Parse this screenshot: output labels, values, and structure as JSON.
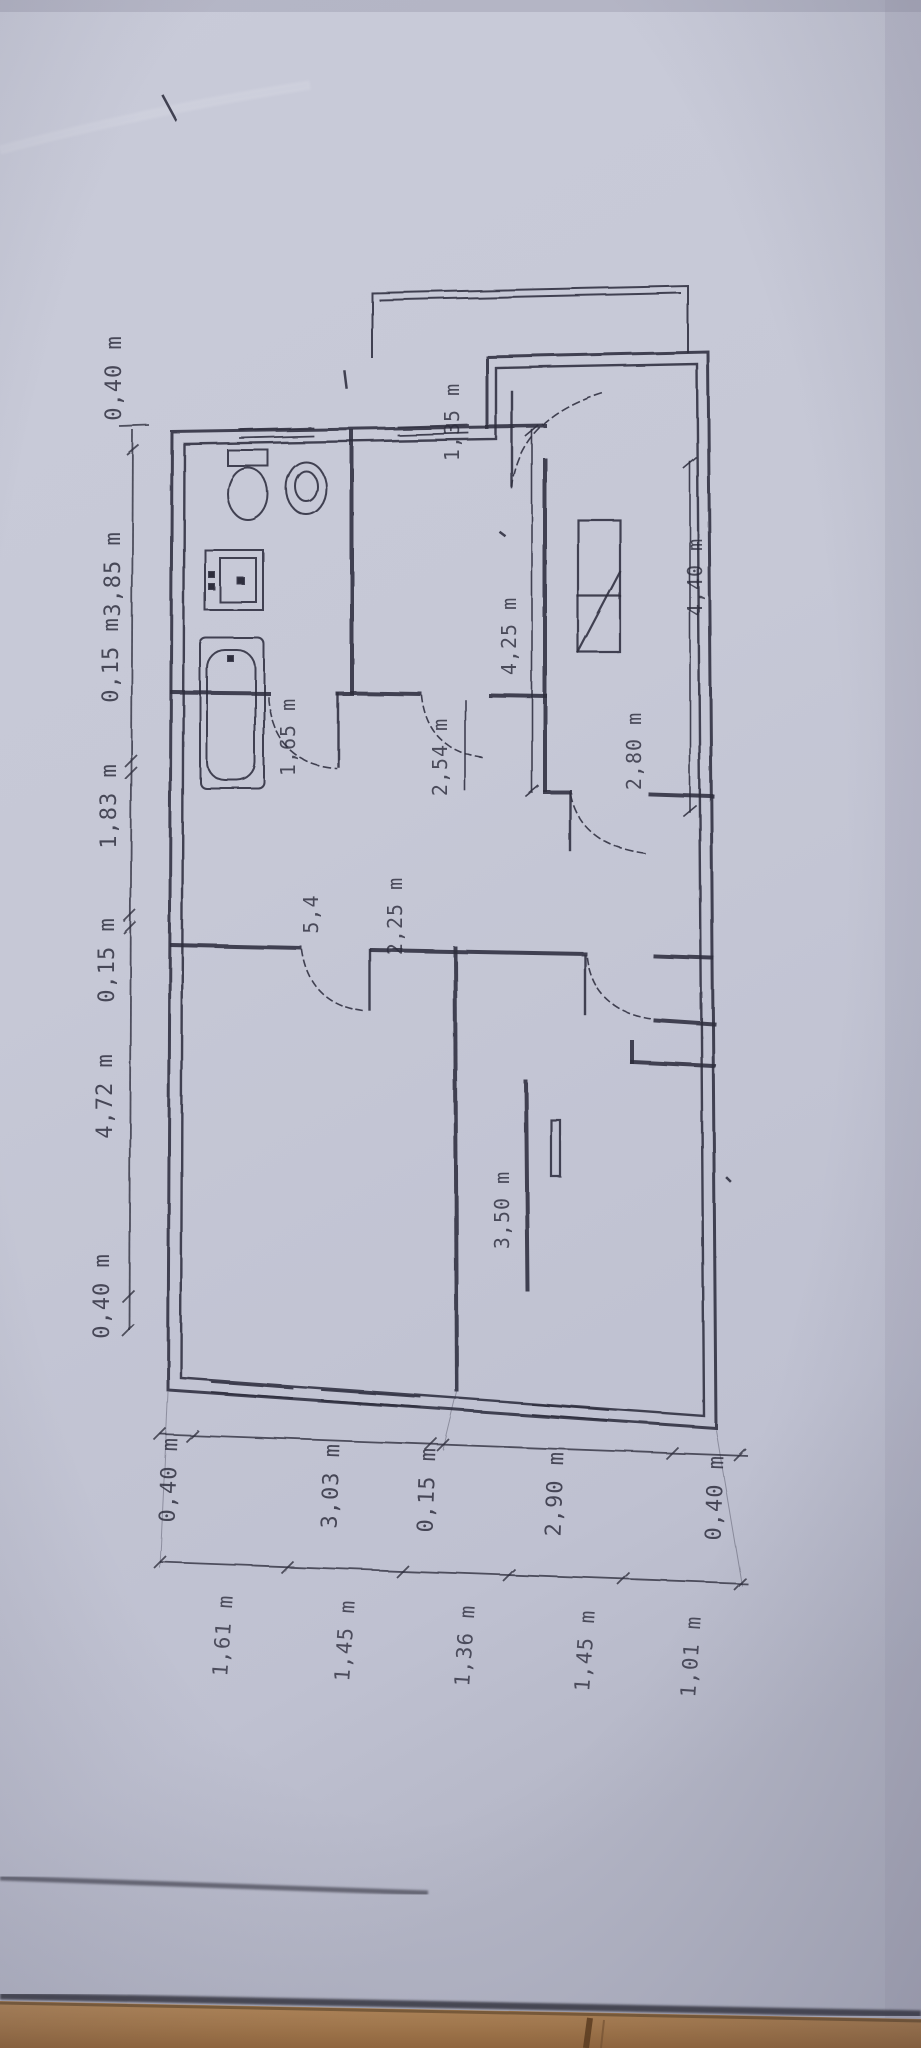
{
  "plan": {
    "dims_left": [
      "0,40 m",
      "3,85 m",
      "0,15 m",
      "1,83 m",
      "0,15 m",
      "4,72 m",
      "0,40 m"
    ],
    "dims_bottom_inner": [
      "0,40 m",
      "3,03 m",
      "0,15 m",
      "2,90 m",
      "0,40 m"
    ],
    "dims_bottom_outer": [
      "1,61 m",
      "1,45 m",
      "1,36 m",
      "1,45 m",
      "1,01 m"
    ],
    "dims_interior": {
      "entry_hall": "1,35 m",
      "hall_length": "4,25 m",
      "small_room": "2,54 m",
      "bath_hall": "1,65 m",
      "kitchen_width": "2,80 m",
      "kitchen_length": "4,40 m",
      "corridor": "2,25 m",
      "corridor_small": "5,4",
      "bedroom_right": "3,50 m"
    },
    "fixture_names": [
      "toilet",
      "bidet",
      "washbasin",
      "bathtub",
      "kitchen-unit",
      "door-swing",
      "window"
    ],
    "colors": {
      "paper": "#c6c8d6",
      "ink": "#2c2c3c",
      "wood_floor": "#ab7f51"
    }
  }
}
